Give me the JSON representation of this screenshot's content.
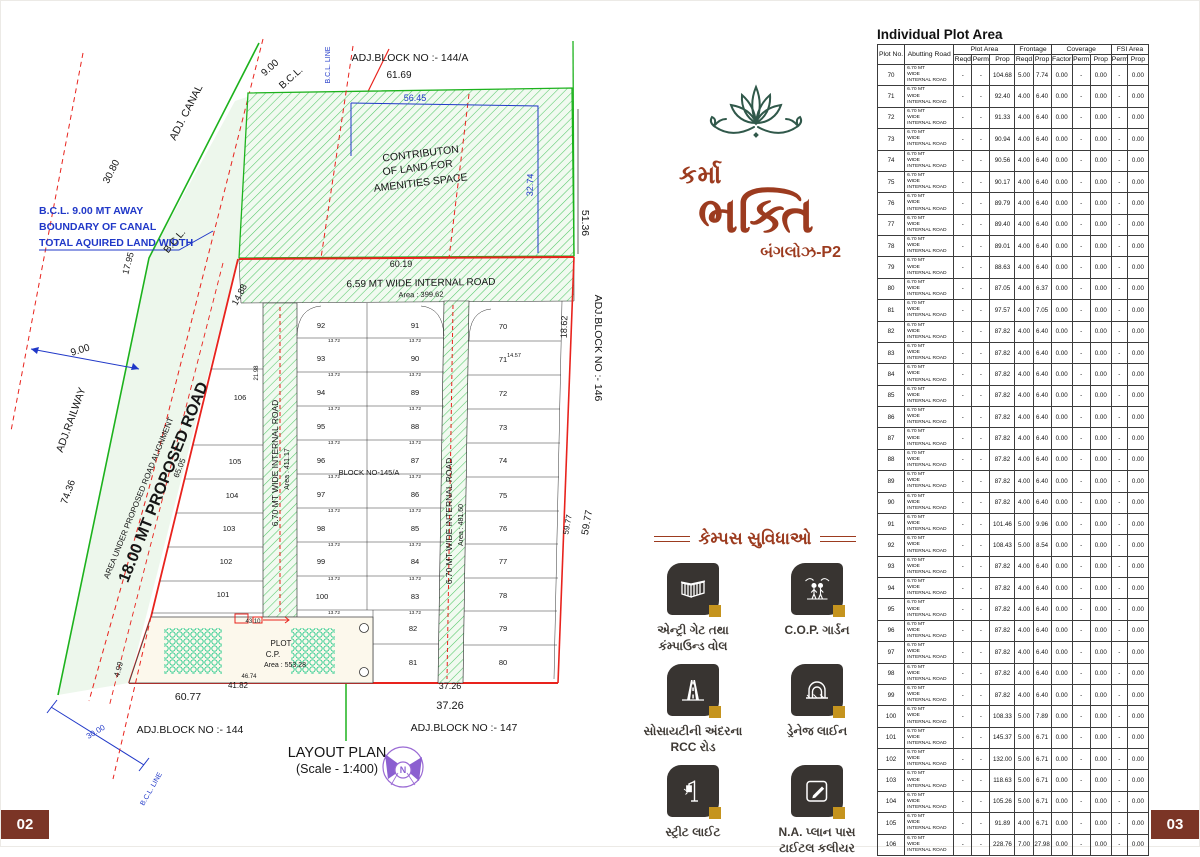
{
  "page": {
    "left_number": "02",
    "right_number": "03"
  },
  "logo": {
    "lotus_icon": "lotus-icon",
    "name_line1": "કર્મા",
    "name_line2": "ભક્તિ",
    "subtitle": "બંગલોઝ-P2",
    "brand_color": "#9c3b1f",
    "lotus_color": "#30584a"
  },
  "amenities": {
    "heading": "કેમ્પસ સુવિધાઓ",
    "items": [
      {
        "icon": "entry-gate-icon",
        "label": "એન્ટ્રી ગેટ તથા\nકંમ્પાઉન્ડ વોલ"
      },
      {
        "icon": "cop-garden-icon",
        "label": "C.O.P. ગાર્ડન"
      },
      {
        "icon": "rcc-road-icon",
        "label": "સોસાયટીની અંદરના\nRCC રોડ"
      },
      {
        "icon": "drainage-icon",
        "label": "ડ્રેનેજ લાઈન"
      },
      {
        "icon": "street-light-icon",
        "label": "સ્ટ્રીટ લાઈટ"
      },
      {
        "icon": "na-plan-icon",
        "label": "N.A. પ્લાન પાસ\nટાઈટલ કલીયર"
      }
    ]
  },
  "plan": {
    "title": "LAYOUT PLAN",
    "scale": "(Scale - 1:400)",
    "colors": {
      "red": "#e8231d",
      "green": "#1db21d",
      "blue": "#2038c8",
      "purple": "#8b5fd0"
    },
    "labels": [
      {
        "t": "ADJ.BLOCK NO :- 144/A",
        "x": 409,
        "y": 60,
        "s": 10.5
      },
      {
        "t": "61.69",
        "x": 398,
        "y": 77,
        "s": 10
      },
      {
        "t": "56.45",
        "x": 414,
        "y": 100,
        "s": 9,
        "c": "blue"
      },
      {
        "t": "CONTRIBUTON",
        "x": 420,
        "y": 156,
        "s": 10.5,
        "r": -7
      },
      {
        "t": "OF LAND FOR",
        "x": 417,
        "y": 170,
        "s": 10.5,
        "r": -7
      },
      {
        "t": "AMENITIES SPACE",
        "x": 420,
        "y": 185,
        "s": 10.5,
        "r": -7
      },
      {
        "t": "ADJ. CANAL",
        "x": 188,
        "y": 113,
        "s": 10.5,
        "r": -63
      },
      {
        "t": "30.80",
        "x": 113,
        "y": 172,
        "s": 10,
        "r": -63
      },
      {
        "t": "9.00",
        "x": 271,
        "y": 69,
        "s": 10,
        "r": -42
      },
      {
        "t": "B.C.L.",
        "x": 292,
        "y": 79,
        "s": 10,
        "r": -42
      },
      {
        "t": "B.C.L. LINE",
        "x": 329,
        "y": 64,
        "s": 7,
        "r": -90,
        "c": "blue"
      },
      {
        "t": "B.C.L. 9.00 MT AWAY",
        "x": 38,
        "y": 213,
        "s": 10.5,
        "c": "blue",
        "a": "start",
        "w": "bold"
      },
      {
        "t": "BOUNDARY OF CANAL",
        "x": 38,
        "y": 229,
        "s": 10.5,
        "c": "blue",
        "a": "start",
        "w": "bold"
      },
      {
        "t": "TOTAL AQUIRED LAND WIDTH",
        "x": 38,
        "y": 245,
        "s": 10.5,
        "c": "blue",
        "a": "start",
        "w": "bold"
      },
      {
        "t": "17.95",
        "x": 130,
        "y": 263,
        "s": 9,
        "r": -75
      },
      {
        "t": "B.C.L.",
        "x": 176,
        "y": 242,
        "s": 10,
        "r": -50
      },
      {
        "t": "9.00",
        "x": 80,
        "y": 352,
        "s": 10,
        "r": -17
      },
      {
        "t": "ADJ.RAILWAY",
        "x": 73,
        "y": 420,
        "s": 10.5,
        "r": -70
      },
      {
        "t": "74.36",
        "x": 70,
        "y": 492,
        "s": 10,
        "r": -70
      },
      {
        "t": "AREA UNDER PROPOSED ROAD ALIGNMENT",
        "x": 140,
        "y": 498,
        "s": 8,
        "r": -68
      },
      {
        "t": "18.00 MT PROPOSED ROAD",
        "x": 167,
        "y": 483,
        "s": 16,
        "r": -68,
        "w": "bold"
      },
      {
        "t": "65.05",
        "x": 181,
        "y": 468,
        "s": 8,
        "r": -68
      },
      {
        "t": "14.88",
        "x": 241,
        "y": 295,
        "s": 9,
        "r": -62
      },
      {
        "t": "60.19",
        "x": 400,
        "y": 266,
        "s": 9
      },
      {
        "t": "6.59  MT WIDE INTERNAL ROAD",
        "x": 420,
        "y": 285,
        "s": 10,
        "r": -1
      },
      {
        "t": "Area : 399.62",
        "x": 420,
        "y": 296,
        "s": 7.5,
        "r": -1
      },
      {
        "t": "6.70 MT WIDE INTERNAL ROAD",
        "x": 277,
        "y": 462,
        "s": 8.5,
        "r": -90
      },
      {
        "t": "Area : 411.17",
        "x": 288,
        "y": 468,
        "s": 7,
        "r": -90
      },
      {
        "t": "6.70 MT WIDE INTERNAL ROAD",
        "x": 451,
        "y": 520,
        "s": 8.5,
        "r": -90
      },
      {
        "t": "Area : 481.60",
        "x": 462,
        "y": 524,
        "s": 7,
        "r": -90
      },
      {
        "t": "BLOCK NO-145/A",
        "x": 368,
        "y": 474,
        "s": 7.5
      },
      {
        "t": "21.98",
        "x": 257,
        "y": 372,
        "s": 6,
        "r": -90
      },
      {
        "t": "14.57",
        "x": 513,
        "y": 356,
        "s": 5.5
      },
      {
        "t": "18.62",
        "x": 566,
        "y": 326,
        "s": 9,
        "r": -88
      },
      {
        "t": "ADJ.BLOCK NO :- 146",
        "x": 594,
        "y": 347,
        "s": 10.5,
        "r": 90
      },
      {
        "t": "59.77",
        "x": 569,
        "y": 524,
        "s": 8,
        "r": -80
      },
      {
        "t": "59.77",
        "x": 589,
        "y": 522,
        "s": 10,
        "r": -80
      },
      {
        "t": "51.36",
        "x": 581,
        "y": 222,
        "s": 10.5,
        "r": 90
      },
      {
        "t": "32.74",
        "x": 532,
        "y": 184,
        "s": 9,
        "r": -88,
        "c": "blue"
      },
      {
        "t": "PLOT",
        "x": 280,
        "y": 645,
        "s": 8
      },
      {
        "t": "C.P.",
        "x": 272,
        "y": 656,
        "s": 8
      },
      {
        "t": "Area : 553.28",
        "x": 284,
        "y": 666,
        "s": 7
      },
      {
        "t": "43.10",
        "x": 252,
        "y": 622,
        "s": 6
      },
      {
        "t": "46.74",
        "x": 248,
        "y": 677,
        "s": 6
      },
      {
        "t": "41.82",
        "x": 237,
        "y": 687,
        "s": 8
      },
      {
        "t": "60.77",
        "x": 187,
        "y": 699,
        "s": 10.5
      },
      {
        "t": "4.99",
        "x": 120,
        "y": 669,
        "s": 8,
        "r": -75
      },
      {
        "t": "37.26",
        "x": 449,
        "y": 688,
        "s": 9
      },
      {
        "t": "37.26",
        "x": 449,
        "y": 708,
        "s": 11
      },
      {
        "t": "ADJ.BLOCK NO :- 147",
        "x": 463,
        "y": 730,
        "s": 10.5
      },
      {
        "t": "ADJ.BLOCK NO :- 144",
        "x": 189,
        "y": 732,
        "s": 10.5
      },
      {
        "t": "30.00",
        "x": 96,
        "y": 733,
        "s": 8,
        "r": -31,
        "c": "blue"
      },
      {
        "t": "B.C.L. LINE",
        "x": 152,
        "y": 789,
        "s": 7,
        "r": -60,
        "c": "blue"
      },
      {
        "t": "N",
        "x": 402,
        "y": 772,
        "s": 9,
        "c": "#8b5fd0",
        "w": "bold"
      }
    ],
    "row_dims": {
      "label": "13.72",
      "xs": [
        333,
        414
      ],
      "ys": [
        339,
        373,
        407,
        441,
        475,
        509,
        543,
        577,
        611
      ]
    },
    "plots": [
      {
        "n": "106",
        "x": 239,
        "y": 399
      },
      {
        "n": "105",
        "x": 234,
        "y": 463
      },
      {
        "n": "104",
        "x": 231,
        "y": 497
      },
      {
        "n": "103",
        "x": 228,
        "y": 530
      },
      {
        "n": "102",
        "x": 225,
        "y": 563
      },
      {
        "n": "101",
        "x": 222,
        "y": 596
      },
      {
        "n": "92",
        "x": 320,
        "y": 327
      },
      {
        "n": "93",
        "x": 320,
        "y": 360
      },
      {
        "n": "94",
        "x": 320,
        "y": 394
      },
      {
        "n": "95",
        "x": 320,
        "y": 428
      },
      {
        "n": "96",
        "x": 320,
        "y": 462
      },
      {
        "n": "97",
        "x": 320,
        "y": 496
      },
      {
        "n": "98",
        "x": 320,
        "y": 530
      },
      {
        "n": "99",
        "x": 320,
        "y": 563
      },
      {
        "n": "100",
        "x": 321,
        "y": 598
      },
      {
        "n": "91",
        "x": 414,
        "y": 327
      },
      {
        "n": "90",
        "x": 414,
        "y": 360
      },
      {
        "n": "89",
        "x": 414,
        "y": 394
      },
      {
        "n": "88",
        "x": 414,
        "y": 428
      },
      {
        "n": "87",
        "x": 414,
        "y": 462
      },
      {
        "n": "86",
        "x": 414,
        "y": 496
      },
      {
        "n": "85",
        "x": 414,
        "y": 530
      },
      {
        "n": "84",
        "x": 414,
        "y": 563
      },
      {
        "n": "83",
        "x": 414,
        "y": 598
      },
      {
        "n": "82",
        "x": 412,
        "y": 630
      },
      {
        "n": "81",
        "x": 412,
        "y": 664
      },
      {
        "n": "70",
        "x": 502,
        "y": 328
      },
      {
        "n": "71",
        "x": 502,
        "y": 361
      },
      {
        "n": "72",
        "x": 502,
        "y": 395
      },
      {
        "n": "73",
        "x": 502,
        "y": 429
      },
      {
        "n": "74",
        "x": 502,
        "y": 462
      },
      {
        "n": "75",
        "x": 502,
        "y": 497
      },
      {
        "n": "76",
        "x": 502,
        "y": 530
      },
      {
        "n": "77",
        "x": 502,
        "y": 563
      },
      {
        "n": "78",
        "x": 502,
        "y": 597
      },
      {
        "n": "79",
        "x": 502,
        "y": 630
      },
      {
        "n": "80",
        "x": 502,
        "y": 664
      }
    ]
  },
  "table": {
    "title": "Individual Plot Area",
    "col_groups": [
      {
        "label": "Plot No.",
        "rowspan": true
      },
      {
        "label": "Abutting Road",
        "rowspan": true
      },
      {
        "label": "Plot Area",
        "span": 3
      },
      {
        "label": "Frontage",
        "span": 2
      },
      {
        "label": "Coverage",
        "span": 3
      },
      {
        "label": "FSI Area",
        "span": 2
      }
    ],
    "sub_headers": [
      "Reqd",
      "Perm",
      "Prop",
      "Reqd",
      "Prop",
      "Factor",
      "Perm",
      "Prop",
      "Perm",
      "Prop"
    ],
    "road_lines": [
      "6.70 MT",
      "WIDE",
      "INTERNAL ROAD"
    ],
    "defaults": {
      "area_reqd": "-",
      "area_perm": "-",
      "factor": "0.00",
      "cov_perm": "-",
      "cov_prop": "0.00",
      "fsi_perm": "-",
      "fsi_prop": "0.00"
    },
    "rows": [
      {
        "no": "70",
        "area": "104.68",
        "fr": "5.00",
        "fp": "7.74"
      },
      {
        "no": "71",
        "area": "92.40",
        "fr": "4.00",
        "fp": "6.40"
      },
      {
        "no": "72",
        "area": "91.33",
        "fr": "4.00",
        "fp": "6.40"
      },
      {
        "no": "73",
        "area": "90.94",
        "fr": "4.00",
        "fp": "6.40"
      },
      {
        "no": "74",
        "area": "90.56",
        "fr": "4.00",
        "fp": "6.40"
      },
      {
        "no": "75",
        "area": "90.17",
        "fr": "4.00",
        "fp": "6.40"
      },
      {
        "no": "76",
        "area": "89.79",
        "fr": "4.00",
        "fp": "6.40"
      },
      {
        "no": "77",
        "area": "89.40",
        "fr": "4.00",
        "fp": "6.40"
      },
      {
        "no": "78",
        "area": "89.01",
        "fr": "4.00",
        "fp": "6.40"
      },
      {
        "no": "79",
        "area": "88.63",
        "fr": "4.00",
        "fp": "6.40"
      },
      {
        "no": "80",
        "area": "87.05",
        "fr": "4.00",
        "fp": "6.37"
      },
      {
        "no": "81",
        "area": "97.57",
        "fr": "4.00",
        "fp": "7.05"
      },
      {
        "no": "82",
        "area": "87.82",
        "fr": "4.00",
        "fp": "6.40"
      },
      {
        "no": "83",
        "area": "87.82",
        "fr": "4.00",
        "fp": "6.40"
      },
      {
        "no": "84",
        "area": "87.82",
        "fr": "4.00",
        "fp": "6.40"
      },
      {
        "no": "85",
        "area": "87.82",
        "fr": "4.00",
        "fp": "6.40"
      },
      {
        "no": "86",
        "area": "87.82",
        "fr": "4.00",
        "fp": "6.40"
      },
      {
        "no": "87",
        "area": "87.82",
        "fr": "4.00",
        "fp": "6.40"
      },
      {
        "no": "88",
        "area": "87.82",
        "fr": "4.00",
        "fp": "6.40"
      },
      {
        "no": "89",
        "area": "87.82",
        "fr": "4.00",
        "fp": "6.40"
      },
      {
        "no": "90",
        "area": "87.82",
        "fr": "4.00",
        "fp": "6.40"
      },
      {
        "no": "91",
        "area": "101.46",
        "fr": "5.00",
        "fp": "9.96"
      },
      {
        "no": "92",
        "area": "108.43",
        "fr": "5.00",
        "fp": "8.54"
      },
      {
        "no": "93",
        "area": "87.82",
        "fr": "4.00",
        "fp": "6.40"
      },
      {
        "no": "94",
        "area": "87.82",
        "fr": "4.00",
        "fp": "6.40"
      },
      {
        "no": "95",
        "area": "87.82",
        "fr": "4.00",
        "fp": "6.40"
      },
      {
        "no": "96",
        "area": "87.82",
        "fr": "4.00",
        "fp": "6.40"
      },
      {
        "no": "97",
        "area": "87.82",
        "fr": "4.00",
        "fp": "6.40"
      },
      {
        "no": "98",
        "area": "87.82",
        "fr": "4.00",
        "fp": "6.40"
      },
      {
        "no": "99",
        "area": "87.82",
        "fr": "4.00",
        "fp": "6.40"
      },
      {
        "no": "100",
        "area": "108.33",
        "fr": "5.00",
        "fp": "7.89"
      },
      {
        "no": "101",
        "area": "145.37",
        "fr": "5.00",
        "fp": "6.71"
      },
      {
        "no": "102",
        "area": "132.00",
        "fr": "5.00",
        "fp": "6.71"
      },
      {
        "no": "103",
        "area": "118.63",
        "fr": "5.00",
        "fp": "6.71"
      },
      {
        "no": "104",
        "area": "105.26",
        "fr": "5.00",
        "fp": "6.71"
      },
      {
        "no": "105",
        "area": "91.89",
        "fr": "4.00",
        "fp": "6.71"
      },
      {
        "no": "106",
        "area": "228.76",
        "fr": "7.00",
        "fp": "27.98"
      }
    ]
  }
}
